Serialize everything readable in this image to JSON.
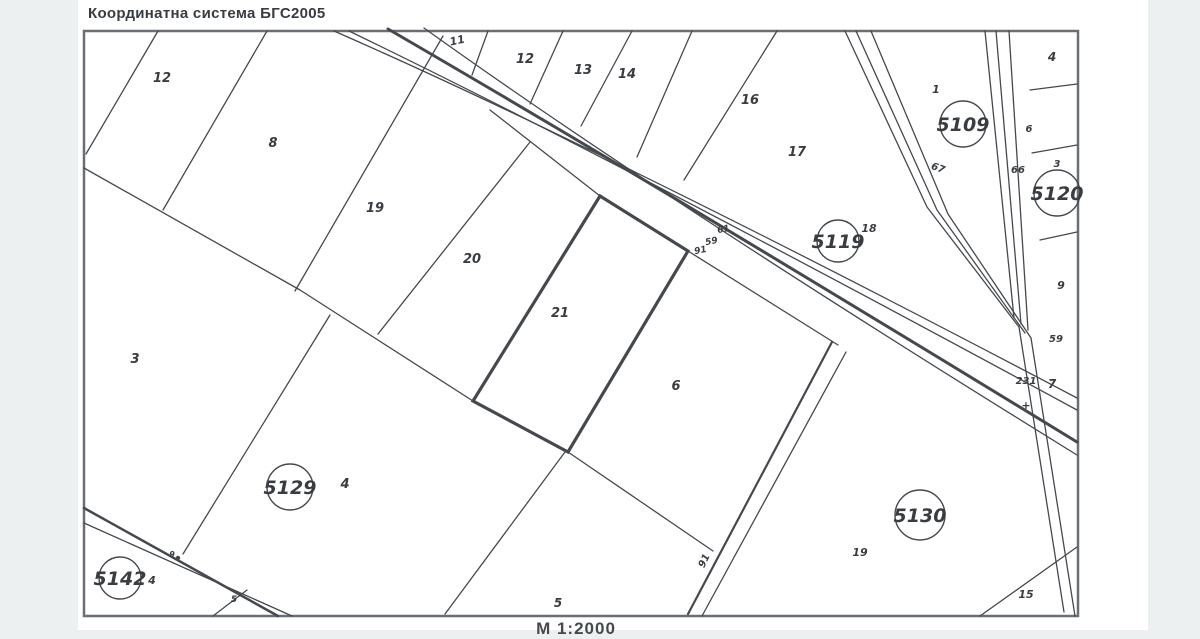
{
  "page": {
    "title": "Координатна система БГС2005",
    "scale_label": "М 1:2000"
  },
  "colors": {
    "paper": "#ffffff",
    "margin_gray": "#edf0f0",
    "line": "#45494e",
    "border": "#6a6f74",
    "label": "#393d41"
  },
  "map": {
    "border": {
      "x": 84,
      "y": 31,
      "w": 994,
      "h": 585
    },
    "highlight_parcel": {
      "number": "21",
      "points": "600,196 688,251 568,452 473,401",
      "stroke_width": 3.2
    },
    "lines": [
      {
        "n": "road-line",
        "d": "M334,31 Q610,152 1077,398",
        "w": 1.3
      },
      {
        "n": "road-line",
        "d": "M349,31 Q620,162 1077,410",
        "w": 1.3
      },
      {
        "n": "road-line",
        "d": "M388,29 Q645,178 1077,442",
        "w": 3
      },
      {
        "n": "road-line",
        "d": "M424,28 Q658,196 1077,455",
        "w": 1.3
      },
      {
        "n": "road-line",
        "d": "M490,110 L600,196 L688,251 L838,345",
        "w": 1.3
      },
      {
        "n": "road-line",
        "d": "M832,342 L688,614",
        "w": 2.2
      },
      {
        "n": "road-line",
        "d": "M846,352 L702,616",
        "w": 1.3
      },
      {
        "n": "parcel-boundary-line",
        "d": "M84,168 L300,290 L473,401 L568,452 L713,551",
        "w": 1.3
      },
      {
        "n": "parcel-boundary-line",
        "d": "M158,31 L86,154",
        "w": 1.3
      },
      {
        "n": "parcel-boundary-line",
        "d": "M267,31 L163,210",
        "w": 1.3
      },
      {
        "n": "parcel-boundary-line",
        "d": "M443,36 L295,291",
        "w": 1.3
      },
      {
        "n": "parcel-boundary-line",
        "d": "M530,142 L378,334",
        "w": 1.3
      },
      {
        "n": "parcel-boundary-line",
        "d": "M330,315 L183,554",
        "w": 1.3
      },
      {
        "n": "parcel-boundary-line",
        "d": "M565,452 L445,614",
        "w": 1.3
      },
      {
        "n": "parcel-boundary-line",
        "d": "M488,31 L472,75",
        "w": 1.3
      },
      {
        "n": "parcel-boundary-line",
        "d": "M563,31 L530,104",
        "w": 1.3
      },
      {
        "n": "parcel-boundary-line",
        "d": "M632,31 L581,126",
        "w": 1.3
      },
      {
        "n": "parcel-boundary-line",
        "d": "M692,31 L637,157",
        "w": 1.3
      },
      {
        "n": "parcel-boundary-line",
        "d": "M777,31 L684,180",
        "w": 1.3
      },
      {
        "n": "road-line",
        "d": "M845,31 L927,207 L1019,327",
        "w": 1.3
      },
      {
        "n": "road-line",
        "d": "M856,31 L937,210 L1025,333",
        "w": 1.3
      },
      {
        "n": "road-line",
        "d": "M871,31 L948,214 L1031,338",
        "w": 1.3
      },
      {
        "n": "road-line",
        "d": "M985,31 L1014,318",
        "w": 1.3
      },
      {
        "n": "road-line",
        "d": "M996,31 L1021,324",
        "w": 1.3
      },
      {
        "n": "road-line",
        "d": "M1009,31 L1028,330",
        "w": 1.3
      },
      {
        "n": "road-line",
        "d": "M1019,327 L1064,612",
        "w": 1.3
      },
      {
        "n": "road-line",
        "d": "M1031,338 L1075,616",
        "w": 1.3
      },
      {
        "n": "parcel-boundary-line",
        "d": "M1030,90 L1077,84",
        "w": 1.3
      },
      {
        "n": "parcel-boundary-line",
        "d": "M1032,153 L1077,145",
        "w": 1.3
      },
      {
        "n": "parcel-boundary-line",
        "d": "M1040,240 L1077,232",
        "w": 1.3
      },
      {
        "n": "parcel-boundary-line",
        "d": "M1077,547 L980,616",
        "w": 1.3
      },
      {
        "n": "road-line",
        "d": "M84,508 L278,616",
        "w": 2.5
      },
      {
        "n": "road-line",
        "d": "M84,523 L292,616",
        "w": 1.3
      },
      {
        "n": "road-line",
        "d": "M213,616 L247,590",
        "w": 1.3
      }
    ],
    "dots": [
      {
        "x": 178,
        "y": 558,
        "r": 2.2
      }
    ],
    "zones": [
      {
        "id": "5109",
        "x": 963,
        "y": 124,
        "r": 23
      },
      {
        "id": "5119",
        "x": 838,
        "y": 241,
        "r": 21
      },
      {
        "id": "5120",
        "x": 1057,
        "y": 193,
        "r": 23
      },
      {
        "id": "5129",
        "x": 290,
        "y": 487,
        "r": 23
      },
      {
        "id": "5130",
        "x": 920,
        "y": 515,
        "r": 25
      },
      {
        "id": "5142",
        "x": 120,
        "y": 578,
        "r": 21
      }
    ],
    "labels": [
      {
        "t": "12",
        "x": 162,
        "y": 82,
        "s": 13
      },
      {
        "t": "8",
        "x": 273,
        "y": 147,
        "s": 13
      },
      {
        "t": "19",
        "x": 375,
        "y": 212,
        "s": 13
      },
      {
        "t": "20",
        "x": 472,
        "y": 263,
        "s": 13
      },
      {
        "t": "21",
        "x": 560,
        "y": 317,
        "s": 13
      },
      {
        "t": "6",
        "x": 676,
        "y": 390,
        "s": 13
      },
      {
        "t": "3",
        "x": 135,
        "y": 363,
        "s": 13
      },
      {
        "t": "4",
        "x": 345,
        "y": 488,
        "s": 13
      },
      {
        "t": "5",
        "x": 558,
        "y": 607,
        "s": 12
      },
      {
        "t": "11",
        "x": 458,
        "y": 44,
        "s": 11,
        "rot": -12
      },
      {
        "t": "12",
        "x": 525,
        "y": 63,
        "s": 13
      },
      {
        "t": "13",
        "x": 583,
        "y": 74,
        "s": 13
      },
      {
        "t": "14",
        "x": 627,
        "y": 78,
        "s": 13
      },
      {
        "t": "16",
        "x": 750,
        "y": 104,
        "s": 13
      },
      {
        "t": "17",
        "x": 797,
        "y": 156,
        "s": 13
      },
      {
        "t": "18",
        "x": 869,
        "y": 232,
        "s": 11
      },
      {
        "t": "1",
        "x": 936,
        "y": 93,
        "s": 11
      },
      {
        "t": "4",
        "x": 1052,
        "y": 61,
        "s": 12
      },
      {
        "t": "6",
        "x": 1029,
        "y": 132,
        "s": 10
      },
      {
        "t": "3",
        "x": 1057,
        "y": 167,
        "s": 10
      },
      {
        "t": "9",
        "x": 1061,
        "y": 289,
        "s": 11
      },
      {
        "t": "7",
        "x": 1052,
        "y": 388,
        "s": 12
      },
      {
        "t": "19",
        "x": 860,
        "y": 556,
        "s": 11
      },
      {
        "t": "15",
        "x": 1026,
        "y": 598,
        "s": 11
      },
      {
        "t": "4",
        "x": 152,
        "y": 584,
        "s": 11
      },
      {
        "t": "61",
        "x": 724,
        "y": 232,
        "s": 9,
        "rot": -12
      },
      {
        "t": "59",
        "x": 712,
        "y": 244,
        "s": 9,
        "rot": -12
      },
      {
        "t": "91",
        "x": 701,
        "y": 253,
        "s": 9,
        "rot": -12
      },
      {
        "t": "67",
        "x": 937,
        "y": 171,
        "s": 10,
        "rot": 20
      },
      {
        "t": "66",
        "x": 1018,
        "y": 173,
        "s": 10
      },
      {
        "t": "59",
        "x": 1056,
        "y": 342,
        "s": 10
      },
      {
        "t": "231",
        "x": 1026,
        "y": 384,
        "s": 10
      },
      {
        "t": "91",
        "x": 707,
        "y": 562,
        "s": 10,
        "rot": -65
      },
      {
        "t": "9",
        "x": 172,
        "y": 557,
        "s": 8
      },
      {
        "t": "5",
        "x": 234,
        "y": 602,
        "s": 9
      },
      {
        "t": "+",
        "x": 1026,
        "y": 409,
        "s": 11
      }
    ]
  }
}
